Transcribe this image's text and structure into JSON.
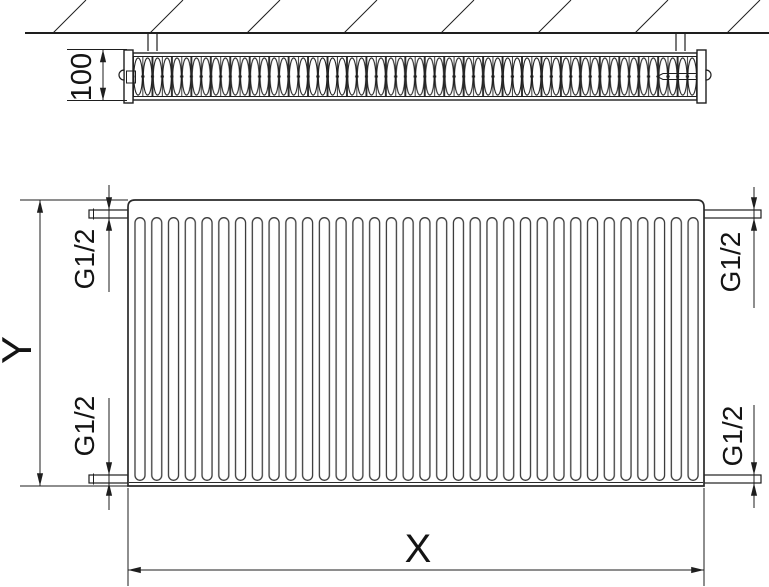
{
  "drawing": {
    "labels": {
      "depth": "100",
      "height": "Y",
      "width": "X",
      "connection_top_left": "G1/2",
      "connection_bottom_left": "G1/2",
      "connection_top_right": "G1/2",
      "connection_bottom_right": "G1/2"
    },
    "colors": {
      "line": "#1e1e1e",
      "background": "#ffffff"
    }
  }
}
